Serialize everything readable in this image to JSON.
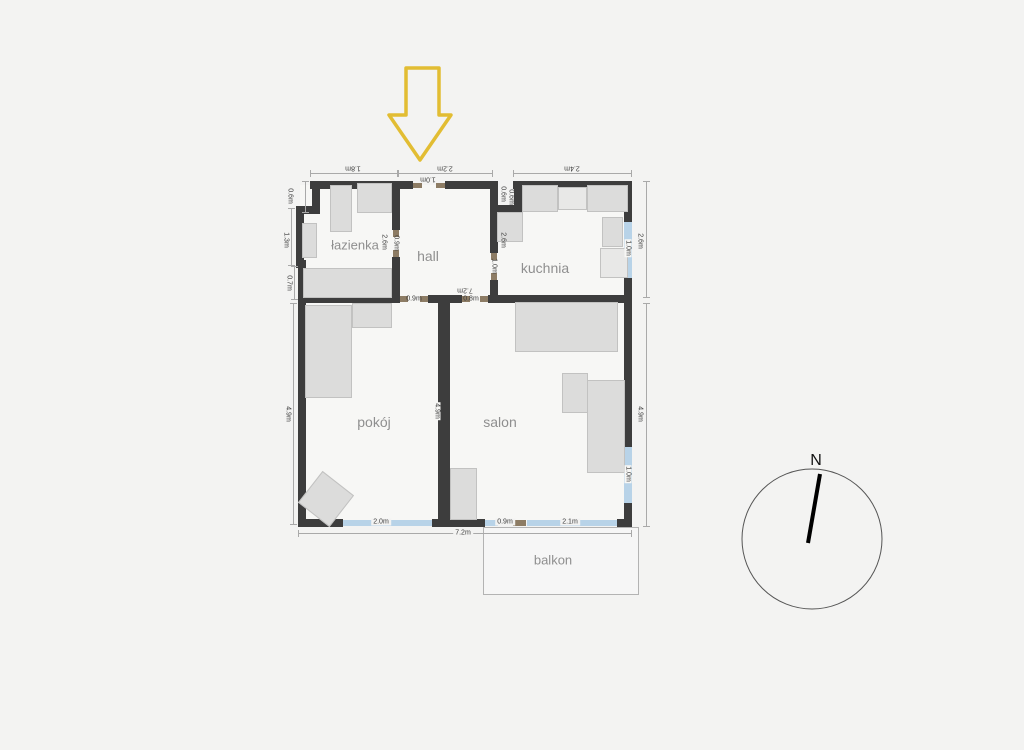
{
  "colors": {
    "wall": "#3d3d3d",
    "window": "#b8d3e8",
    "door": "#8d7c64",
    "arrow": "#e2bd33",
    "furniture": "#dcdcdb",
    "background": "#f3f3f2"
  },
  "rooms": {
    "bathroom": "łazienka",
    "hall": "hall",
    "kitchen": "kuchnia",
    "room": "pokój",
    "living": "salon",
    "balcony": "balkon"
  },
  "compass": {
    "north": "N"
  },
  "dimensions": {
    "top_bathroom": "1.8m",
    "top_hall": "2.2m",
    "top_kitchen": "2.4m",
    "entrance_door": "1.0m",
    "shaft_width": "0.6m",
    "shaft_height": "0.6m",
    "left_upper": "0.6m",
    "left_middle": "1.3m",
    "left_lower": "0.7m",
    "left_room": "4.9m",
    "right_kitchen": "2.6m",
    "right_living": "4.9m",
    "bathroom_wall": "2.6m",
    "bathroom_door": "0.9m",
    "kitchen_wall": "2.6m",
    "kitchen_door": "1.0m",
    "hall_interior_width": "7.2m",
    "room_door": "0.9m",
    "living_door": "0.8m",
    "divider_wall": "4.9m",
    "kitchen_window": "1.0m",
    "living_window": "1.0m",
    "room_window": "2.0m",
    "balcony_door": "0.9m",
    "living_bottom_window": "2.1m",
    "total_width": "7.2m"
  }
}
